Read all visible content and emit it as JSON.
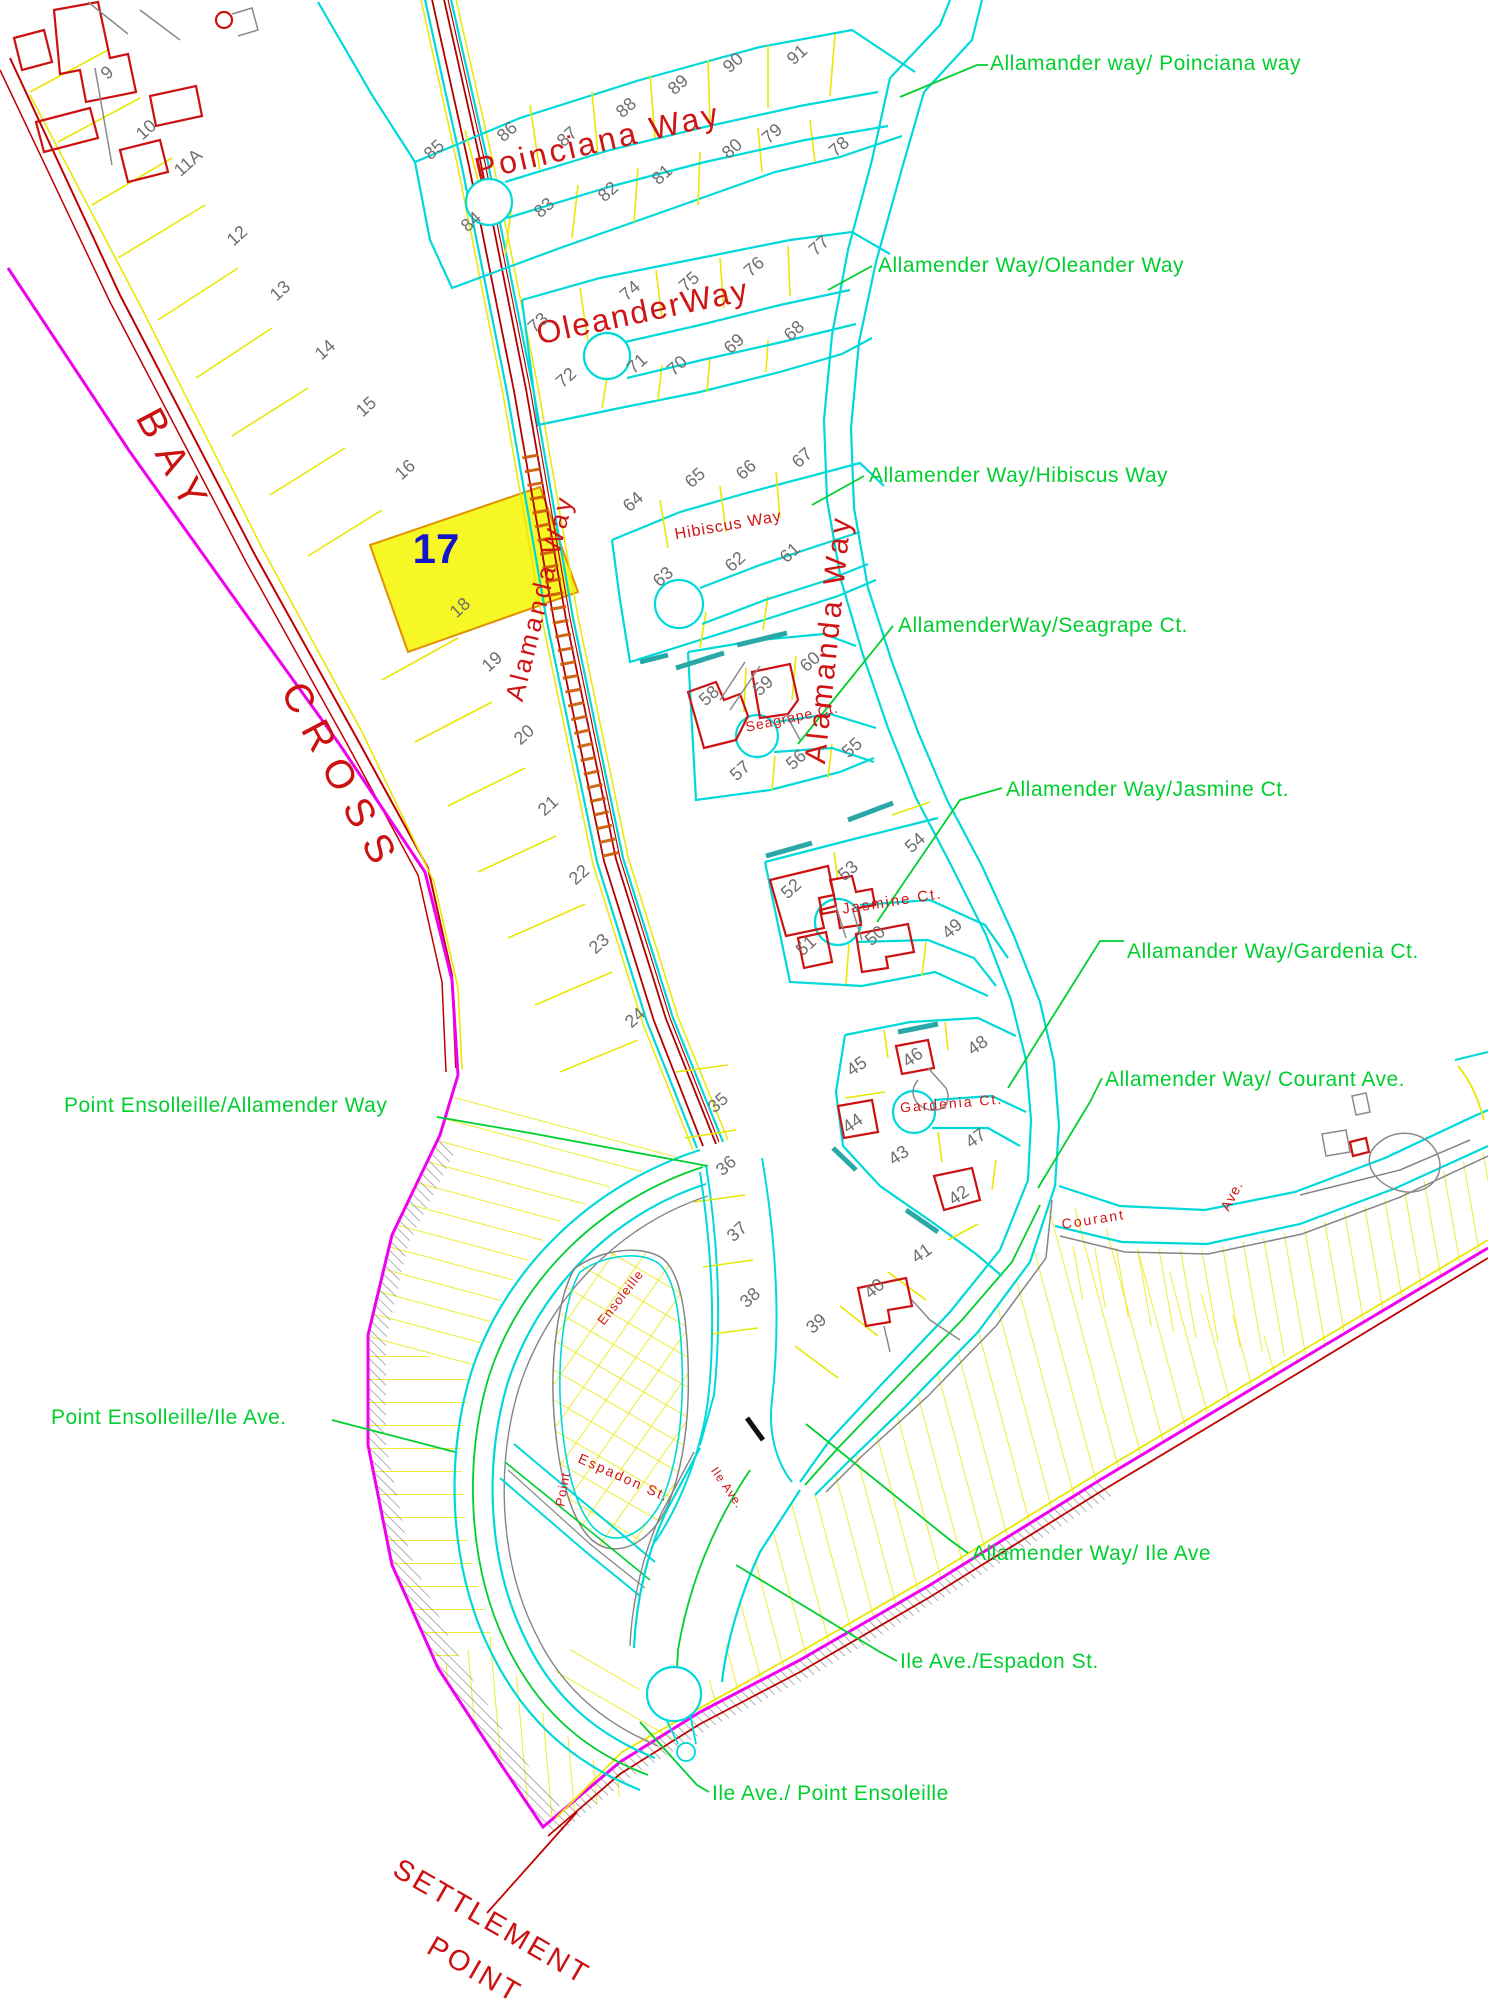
{
  "map_title": "Settlement Point subdivision plat map",
  "colors": {
    "road_cyan": "#00d9d9",
    "lot_yellow": "#e8e800",
    "boundary_red": "#c00000",
    "street_red": "#d01414",
    "magenta": "#f000f0",
    "label_green": "#00cf2e",
    "lot_gray": "#6f6f6f",
    "curb_gray": "#858585",
    "highlight_fill": "#f6f600",
    "highlight_number_blue": "#1414cc",
    "tick_orange": "#cc5500",
    "building_red": "#cc1111"
  },
  "highlight_lot": {
    "number": "17",
    "x": 436,
    "y": 563
  },
  "area_labels": [
    {
      "t": "BAY",
      "x": 163,
      "y": 470,
      "r": 62,
      "s": 40,
      "ls": 14,
      "c": "#cc1111"
    },
    {
      "t": "CROSS",
      "x": 330,
      "y": 785,
      "r": 62,
      "s": 40,
      "ls": 14,
      "c": "#cc1111"
    },
    {
      "t": "SETTLEMENT",
      "x": 487,
      "y": 1930,
      "r": 30,
      "s": 29,
      "ls": 3,
      "c": "#cc1111"
    },
    {
      "t": "POINT",
      "x": 470,
      "y": 1978,
      "r": 30,
      "s": 29,
      "ls": 3,
      "c": "#cc1111"
    }
  ],
  "street_names": [
    {
      "t": "Poinciana Way",
      "x": 600,
      "y": 152,
      "r": -13,
      "s": 32,
      "ls": 3
    },
    {
      "t": "OleanderWay",
      "x": 645,
      "y": 322,
      "r": -12,
      "s": 32,
      "ls": 2
    },
    {
      "t": "Hibiscus  Way",
      "x": 729,
      "y": 530,
      "r": -10,
      "s": 16,
      "ls": 1
    },
    {
      "t": "Alamanda Way",
      "x": 838,
      "y": 640,
      "r": -84,
      "s": 30,
      "ls": 4
    },
    {
      "t": "Alamanda Way",
      "x": 548,
      "y": 600,
      "r": -76,
      "s": 26,
      "ls": 3
    },
    {
      "t": "Seagrape  Ct.",
      "x": 793,
      "y": 722,
      "r": -12,
      "s": 14,
      "ls": 1
    },
    {
      "t": "Jasmine  Ct.",
      "x": 893,
      "y": 906,
      "r": -9,
      "s": 15,
      "ls": 2
    },
    {
      "t": "Gardenia  Ct.",
      "x": 952,
      "y": 1108,
      "r": -5,
      "s": 14,
      "ls": 2
    },
    {
      "t": "Courant",
      "x": 1094,
      "y": 1224,
      "r": -9,
      "s": 14,
      "ls": 2
    },
    {
      "t": "Ave.",
      "x": 1236,
      "y": 1198,
      "r": -62,
      "s": 14,
      "ls": 1
    },
    {
      "t": "Ensoleille",
      "x": 624,
      "y": 1300,
      "r": -52,
      "s": 13,
      "ls": 1
    },
    {
      "t": "Point",
      "x": 567,
      "y": 1490,
      "r": -80,
      "s": 13,
      "ls": 1
    },
    {
      "t": "Espadon  St.",
      "x": 622,
      "y": 1482,
      "r": 24,
      "s": 14,
      "ls": 2
    },
    {
      "t": "Ile  Ave.",
      "x": 724,
      "y": 1490,
      "r": 55,
      "s": 12,
      "ls": 1
    }
  ],
  "junction_labels": [
    {
      "t": "Allamander way/ Poinciana way",
      "x": 990,
      "y": 70
    },
    {
      "t": "Allamender Way/Oleander Way",
      "x": 878,
      "y": 272
    },
    {
      "t": "Allamender Way/Hibiscus Way",
      "x": 869,
      "y": 482
    },
    {
      "t": "AllamenderWay/Seagrape Ct.",
      "x": 898,
      "y": 632
    },
    {
      "t": "Allamender Way/Jasmine Ct.",
      "x": 1006,
      "y": 796
    },
    {
      "t": "Allamander Way/Gardenia Ct.",
      "x": 1127,
      "y": 958
    },
    {
      "t": "Allamender Way/ Courant Ave.",
      "x": 1105,
      "y": 1086
    },
    {
      "t": "Point Ensolleille/Allamender Way",
      "x": 64,
      "y": 1112
    },
    {
      "t": "Point Ensolleille/Ile Ave.",
      "x": 51,
      "y": 1424
    },
    {
      "t": "Allamender Way/ Ile Ave",
      "x": 972,
      "y": 1560
    },
    {
      "t": "Ile Ave./Espadon St.",
      "x": 900,
      "y": 1668
    },
    {
      "t": "Ile Ave./ Point Ensoleille",
      "x": 712,
      "y": 1800
    }
  ],
  "lots": [
    [
      "9",
      111,
      77
    ],
    [
      "10",
      150,
      134
    ],
    [
      "11A",
      192,
      167
    ],
    [
      "12",
      241,
      240
    ],
    [
      "13",
      284,
      295
    ],
    [
      "14",
      329,
      354
    ],
    [
      "15",
      370,
      411
    ],
    [
      "16",
      409,
      474
    ],
    [
      "18",
      464,
      612
    ],
    [
      "19",
      496,
      666
    ],
    [
      "20",
      528,
      739
    ],
    [
      "21",
      552,
      810
    ],
    [
      "22",
      583,
      879
    ],
    [
      "23",
      603,
      948
    ],
    [
      "24",
      639,
      1022
    ],
    [
      "85",
      438,
      154
    ],
    [
      "86",
      511,
      136
    ],
    [
      "87",
      571,
      141
    ],
    [
      "88",
      630,
      112
    ],
    [
      "89",
      682,
      89
    ],
    [
      "90",
      737,
      67
    ],
    [
      "91",
      801,
      59
    ],
    [
      "84",
      475,
      226
    ],
    [
      "83",
      548,
      212
    ],
    [
      "82",
      612,
      196
    ],
    [
      "81",
      666,
      179
    ],
    [
      "80",
      736,
      153
    ],
    [
      "79",
      776,
      138
    ],
    [
      "78",
      843,
      151
    ],
    [
      "73",
      542,
      327
    ],
    [
      "74",
      634,
      295
    ],
    [
      "75",
      693,
      286
    ],
    [
      "76",
      758,
      271
    ],
    [
      "77",
      823,
      250
    ],
    [
      "72",
      570,
      382
    ],
    [
      "71",
      641,
      368
    ],
    [
      "70",
      681,
      370
    ],
    [
      "69",
      738,
      348
    ],
    [
      "68",
      798,
      335
    ],
    [
      "64",
      637,
      506
    ],
    [
      "65",
      699,
      482
    ],
    [
      "66",
      750,
      474
    ],
    [
      "67",
      806,
      462
    ],
    [
      "63",
      667,
      581
    ],
    [
      "62",
      739,
      566
    ],
    [
      "61",
      794,
      557
    ],
    [
      "58",
      713,
      700
    ],
    [
      "59",
      767,
      690
    ],
    [
      "60",
      814,
      666
    ],
    [
      "57",
      744,
      775
    ],
    [
      "56",
      800,
      764
    ],
    [
      "55",
      856,
      752
    ],
    [
      "54",
      919,
      847
    ],
    [
      "52",
      795,
      893
    ],
    [
      "53",
      852,
      875
    ],
    [
      "50",
      879,
      940
    ],
    [
      "49",
      956,
      933
    ],
    [
      "51",
      810,
      950
    ],
    [
      "45",
      860,
      1071,
      -35
    ],
    [
      "46",
      916,
      1062,
      -35
    ],
    [
      "48",
      981,
      1050,
      -35
    ],
    [
      "44",
      856,
      1128,
      -35
    ],
    [
      "43",
      902,
      1160,
      -35
    ],
    [
      "47",
      979,
      1143,
      -35
    ],
    [
      "42",
      962,
      1200,
      -35
    ],
    [
      "41",
      925,
      1258,
      -35
    ],
    [
      "40",
      878,
      1293,
      -40
    ],
    [
      "39",
      820,
      1328,
      -40
    ],
    [
      "35",
      722,
      1107
    ],
    [
      "36",
      730,
      1170
    ],
    [
      "37",
      741,
      1236
    ],
    [
      "38",
      754,
      1302
    ]
  ]
}
